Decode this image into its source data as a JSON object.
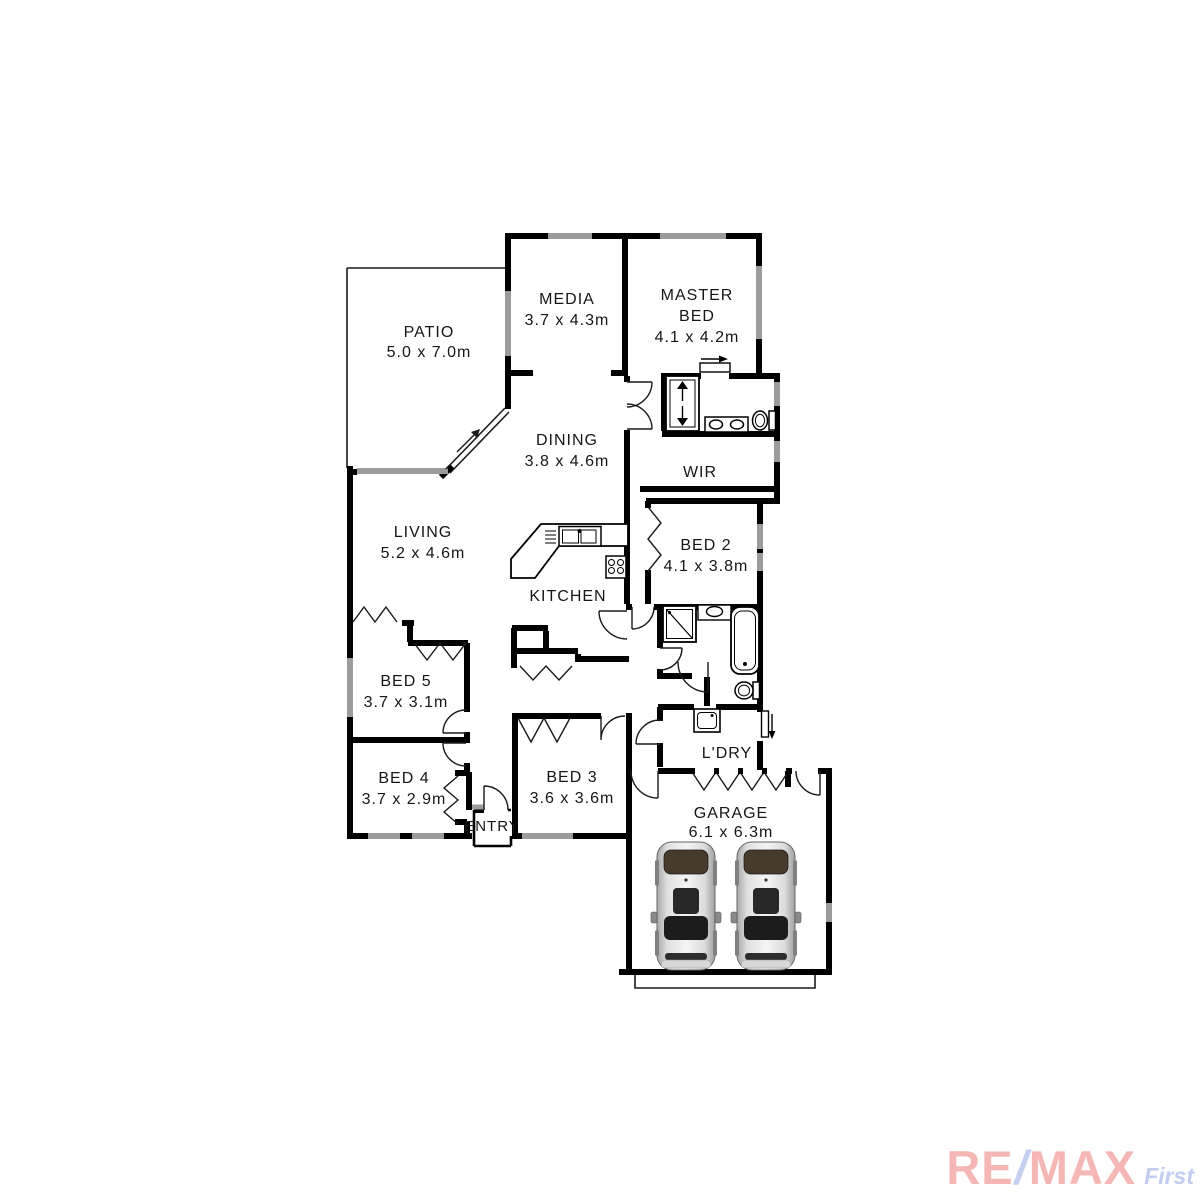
{
  "title": "Residential floor plan",
  "canvas": {
    "width": 1200,
    "height": 1200,
    "background": "#ffffff"
  },
  "colors": {
    "wall": "#000000",
    "window_gray": "#9c9c9c",
    "label_text": "#161616"
  },
  "rooms": {
    "patio": {
      "name": "PATIO",
      "dims": "5.0 x 7.0m"
    },
    "media": {
      "name": "MEDIA",
      "dims": "3.7 x 4.3m"
    },
    "master": {
      "name1": "MASTER",
      "name2": "BED",
      "dims": "4.1 x 4.2m"
    },
    "dining": {
      "name": "DINING",
      "dims": "3.8 x 4.6m"
    },
    "wir": {
      "name": "WIR"
    },
    "living": {
      "name": "LIVING",
      "dims": "5.2 x 4.6m"
    },
    "kitchen": {
      "name": "KITCHEN"
    },
    "bed2": {
      "name": "BED 2",
      "dims": "4.1 x 3.8m"
    },
    "bed5": {
      "name": "BED 5",
      "dims": "3.7 x 3.1m"
    },
    "bed4": {
      "name": "BED 4",
      "dims": "3.7 x 2.9m"
    },
    "bed3": {
      "name": "BED 3",
      "dims": "3.6 x 3.6m"
    },
    "entry": {
      "name": "ENTRY"
    },
    "ldry": {
      "name": "L'DRY"
    },
    "garage": {
      "name": "GARAGE",
      "dims": "6.1 x 6.3m"
    }
  },
  "fixtures": [
    "shower",
    "vanity",
    "toilet",
    "bathtub",
    "kitchen-sink",
    "stove",
    "laundry-tub",
    "car",
    "car"
  ],
  "watermark": {
    "re": "RE",
    "slash": "/",
    "max": "MAX",
    "suffix": "First",
    "remax_color": "#f5b7b4",
    "slash_color": "#c5cff2",
    "suffix_color": "#c3cdf0"
  }
}
